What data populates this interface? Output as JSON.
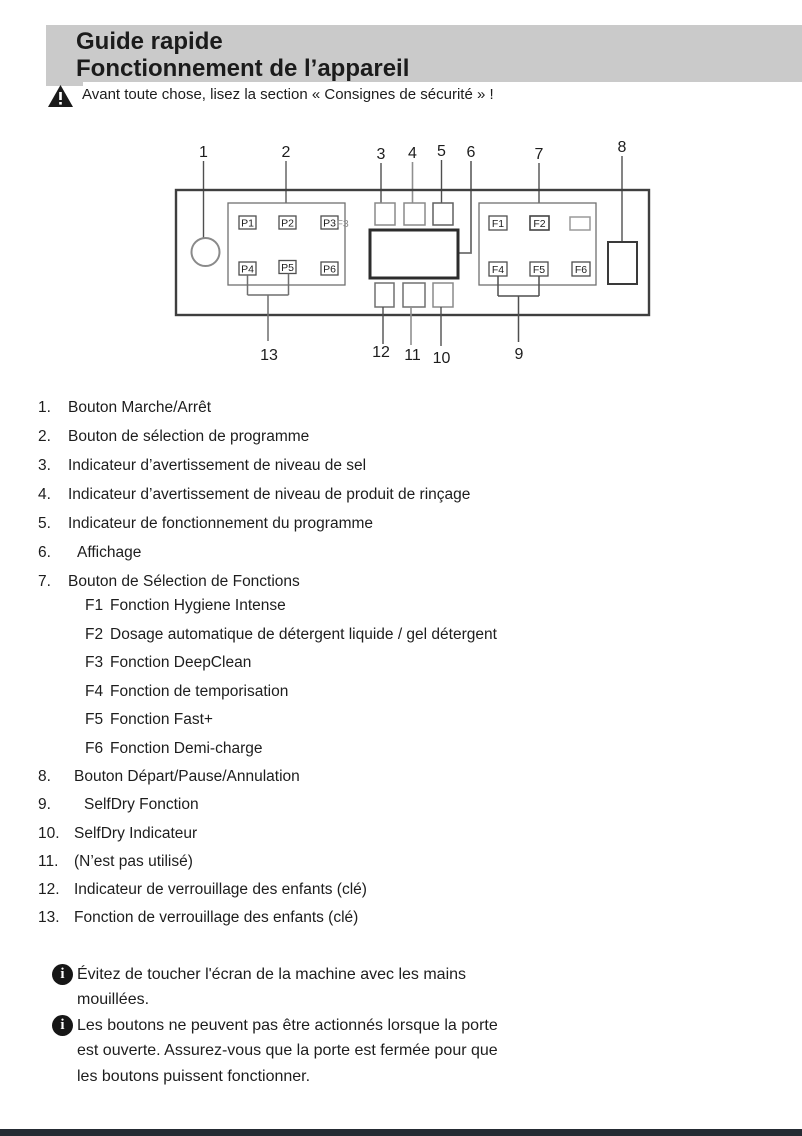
{
  "colors": {
    "header_bg": "#cacaca",
    "footer_bar": "#252b33",
    "text": "#1d1d1d"
  },
  "header": {
    "title_line1": "Guide rapide",
    "title_line2": "Fonctionnement de l’appareil"
  },
  "warning": {
    "text": "Avant toute chose, lisez la section « Consignes de sécurité » !"
  },
  "diagram": {
    "top_callouts": [
      "1",
      "2",
      "3",
      "4",
      "5",
      "6",
      "7",
      "8"
    ],
    "bottom_callouts": [
      "13",
      "12",
      "11",
      "10",
      "9"
    ],
    "program_buttons": [
      "P1",
      "P2",
      "P3",
      "P4",
      "P5",
      "P6"
    ],
    "p3_ghost_label": "F3",
    "function_buttons": [
      "F1",
      "F2",
      "F4",
      "F5",
      "F6"
    ]
  },
  "legend": [
    {
      "num": "1.",
      "text": "Bouton Marche/Arrêt"
    },
    {
      "num": "2.",
      "text": "Bouton de sélection de programme"
    },
    {
      "num": "3.",
      "text": "Indicateur d’avertissement de niveau de sel"
    },
    {
      "num": "4.",
      "text": "Indicateur d’avertissement de niveau de produit de rinçage"
    },
    {
      "num": "5.",
      "text": "Indicateur de fonctionnement du programme"
    },
    {
      "num": "6.",
      "text": "Affichage"
    },
    {
      "num": "7.",
      "text": "Bouton de Sélection de Fonctions"
    },
    {
      "num": "8.",
      "text": "Bouton Départ/Pause/Annulation"
    },
    {
      "num": "9.",
      "text": "SelfDry Fonction"
    },
    {
      "num": "10.",
      "text": "SelfDry Indicateur"
    },
    {
      "num": "11.",
      "text": "(N’est pas utilisé)"
    },
    {
      "num": "12.",
      "text": "Indicateur de verrouillage des enfants (clé)"
    },
    {
      "num": "13.",
      "text": "Fonction de verrouillage des enfants (clé)"
    }
  ],
  "functions": [
    {
      "label": "F1",
      "text": "Fonction Hygiene Intense"
    },
    {
      "label": "F2",
      "text": "Dosage automatique de détergent liquide / gel détergent"
    },
    {
      "label": "F3",
      "text": "Fonction DeepClean"
    },
    {
      "label": "F4",
      "text": "Fonction de temporisation"
    },
    {
      "label": "F5",
      "text": "Fonction Fast+"
    },
    {
      "label": "F6",
      "text": "Fonction Demi-charge"
    }
  ],
  "notes": [
    {
      "lines": [
        "Évitez de toucher l'écran de la machine avec les mains",
        "mouillées."
      ]
    },
    {
      "lines": [
        "Les boutons ne peuvent pas être actionnés lorsque la porte",
        "est ouverte. Assurez-vous que la porte est fermée pour que",
        "les boutons puissent fonctionner."
      ]
    }
  ]
}
